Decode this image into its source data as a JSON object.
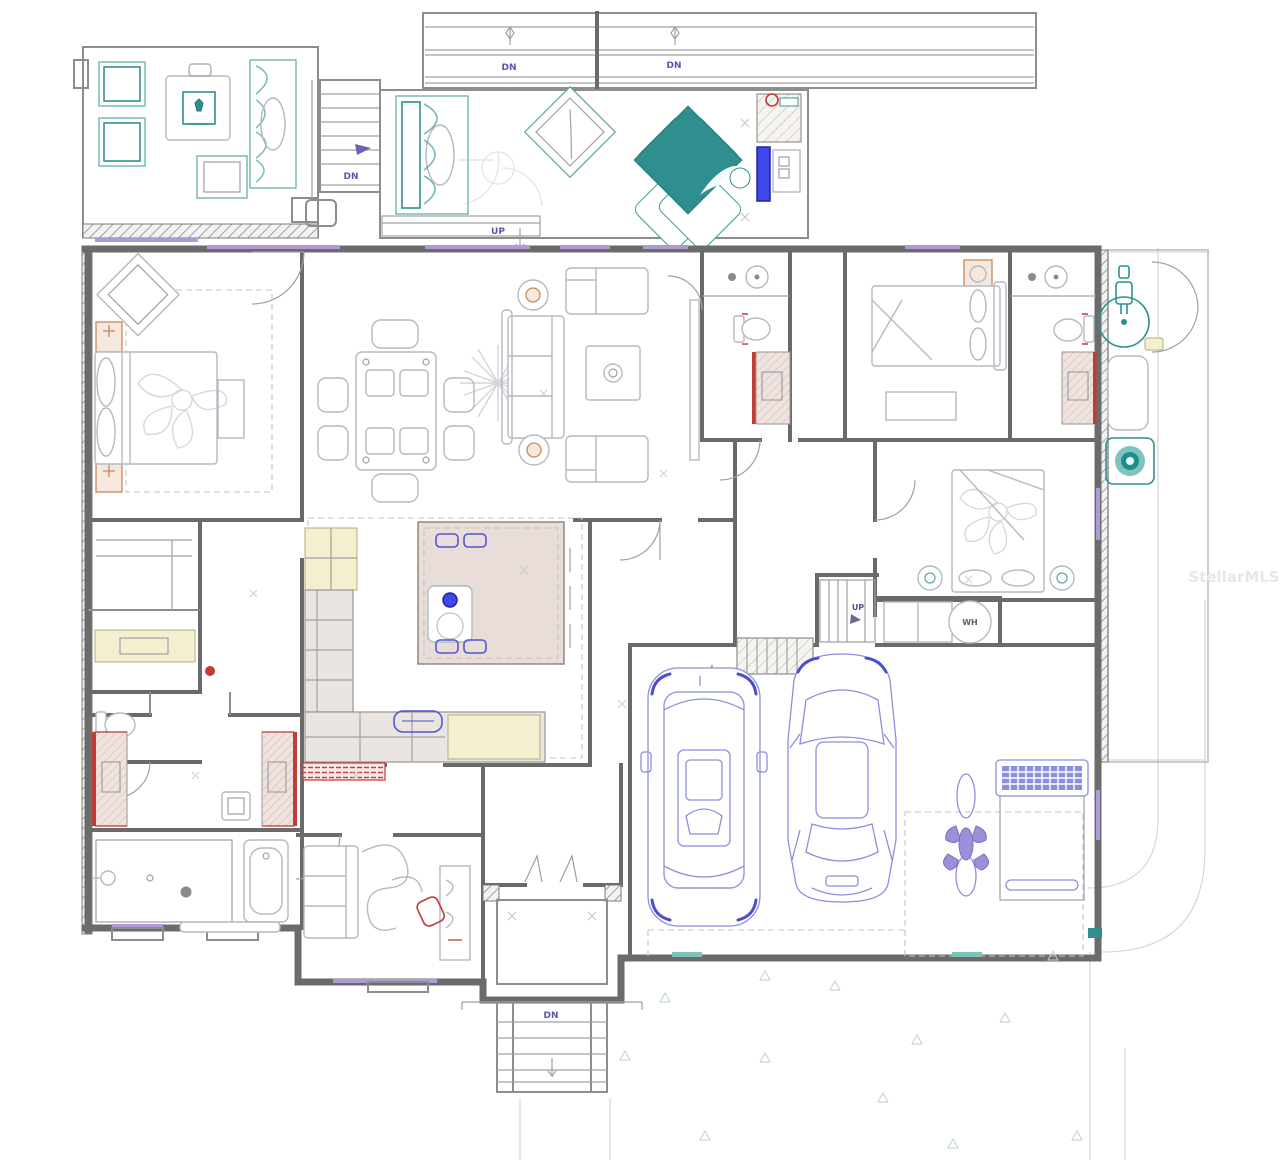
{
  "labels": {
    "down": "DN",
    "up": "UP",
    "water_heater": "WH"
  },
  "watermark": "StellarMLS",
  "palette": {
    "wall_gray": "#6b6b6b",
    "furniture_gray": "#b4b9c2",
    "teal_accent": "#2f8f8f",
    "bright_blue_door": "#4047e8",
    "car_blue": "#8b8fdd",
    "red_accent": "#c23b35",
    "vanity_pink": "#eee1dd",
    "cabinet_cream": "#f4efcf",
    "window_purple": "#b09ad6",
    "lamp_orange": "#c8875a"
  }
}
